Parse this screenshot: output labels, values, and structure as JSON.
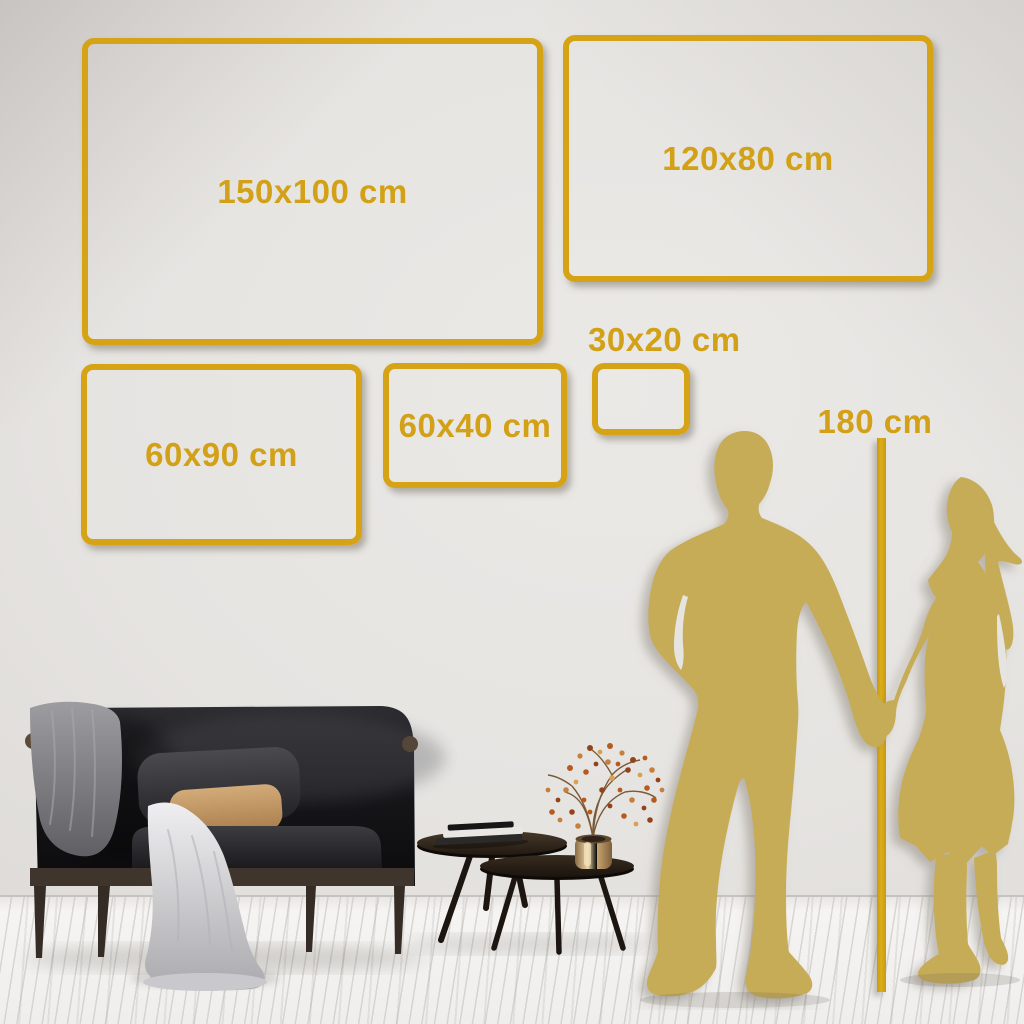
{
  "colors": {
    "accent_gold": "#D6A317",
    "silhouette_gold": "#C7AC59",
    "wall": "#E4E1DE",
    "floor": "#F3F2F0"
  },
  "size_frames": {
    "f150x100": {
      "label": "150x100 cm"
    },
    "f120x80": {
      "label": "120x80 cm"
    },
    "f60x90": {
      "label": "60x90 cm"
    },
    "f60x40": {
      "label": "60x40 cm"
    },
    "f30x20": {
      "label": "30x20 cm"
    }
  },
  "height_marker": {
    "label": "180 cm"
  }
}
